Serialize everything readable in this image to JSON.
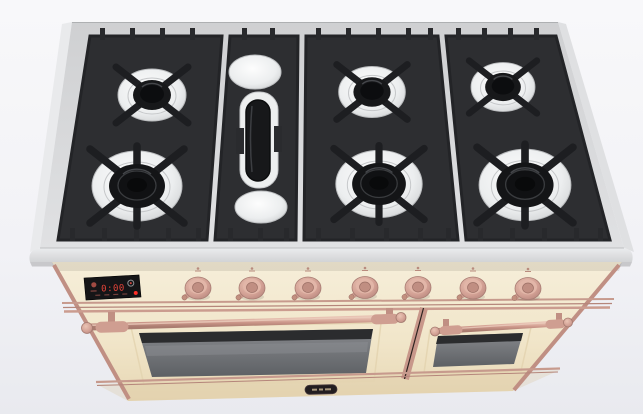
{
  "scene": {
    "description": "Product render of a freestanding dual-fuel range viewed from front-above: stainless gas cooktop with black cast-iron grates, antique-white body with copper trim and knobs, two oven doors",
    "background_color": "#f5f6f9"
  },
  "palette": {
    "cooktop_steel": "#d6d7d9",
    "cooktop_edge": "#e4e5e7",
    "grate_black": "#2d2e31",
    "burner_bowl_white": "#f0f1f2",
    "burner_cap_black": "#141517",
    "body_cream": "#f3e9d1",
    "trim_copper": "#cf9c8f",
    "oven_glass_gray": "#75787b",
    "display_background": "#151517",
    "display_red": "#e8453a"
  },
  "cooktop": {
    "grate_sections": 4,
    "burners": [
      {
        "id": "left-rear",
        "size": "medium"
      },
      {
        "id": "left-front",
        "size": "large"
      },
      {
        "id": "middle-rear",
        "size": "medium"
      },
      {
        "id": "middle-front",
        "size": "large"
      },
      {
        "id": "right-rear",
        "size": "medium"
      },
      {
        "id": "right-front",
        "size": "large"
      },
      {
        "id": "center-griddle",
        "size": "oval"
      }
    ]
  },
  "control_panel": {
    "display": {
      "time": "0:00",
      "indicators": [
        "mode-icon",
        "dial-icon",
        "power-dot"
      ],
      "background": "#151517",
      "digit_color": "#e8453a",
      "power_dot_color": "#ff3028"
    },
    "knobs": [
      {
        "id": "control-knob-1"
      },
      {
        "id": "control-knob-2"
      },
      {
        "id": "control-knob-3"
      },
      {
        "id": "control-knob-4"
      },
      {
        "id": "control-knob-5"
      },
      {
        "id": "control-knob-6"
      },
      {
        "id": "control-knob-7"
      }
    ],
    "knob_color": "#d4a298"
  },
  "ovens": {
    "main_door": {
      "has_window": true,
      "handle_style": "towel-bar",
      "handle_color": "#cf9c8f"
    },
    "secondary_door": {
      "has_window": true,
      "handle_style": "towel-bar",
      "handle_color": "#cf9c8f"
    },
    "badge": {
      "type": "brand-wordmark",
      "legible": false,
      "color": "#221d20"
    }
  }
}
